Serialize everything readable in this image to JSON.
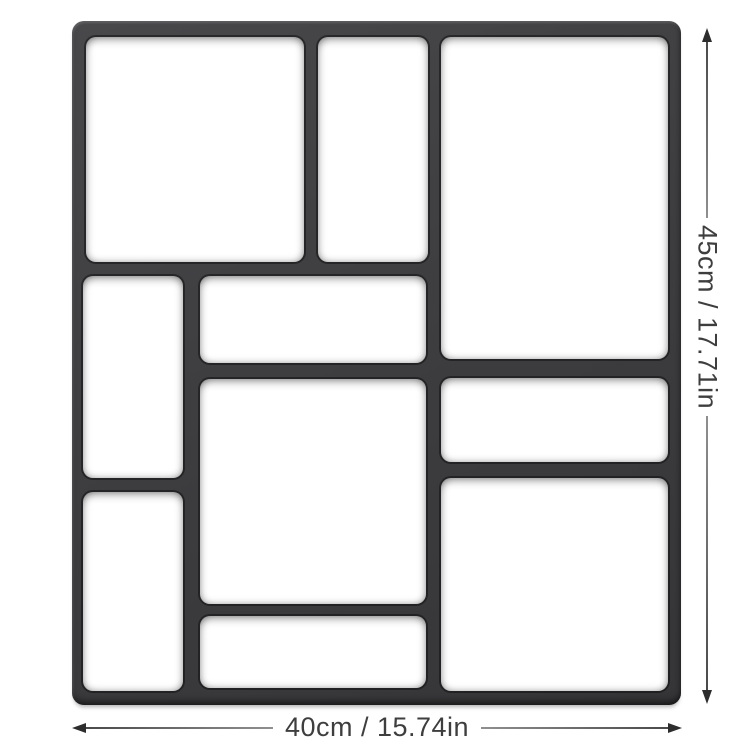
{
  "product": {
    "name": "paving-mold-top-view",
    "cavity_count": 10,
    "cavities": [
      {
        "id": "top-left",
        "x": 14,
        "y": 16,
        "w": 218,
        "h": 225
      },
      {
        "id": "top-center",
        "x": 246,
        "y": 16,
        "w": 110,
        "h": 225
      },
      {
        "id": "top-right",
        "x": 369,
        "y": 16,
        "w": 227,
        "h": 322
      },
      {
        "id": "middle-left",
        "x": 11,
        "y": 255,
        "w": 100,
        "h": 202
      },
      {
        "id": "middle-center",
        "x": 128,
        "y": 255,
        "w": 226,
        "h": 87
      },
      {
        "id": "center",
        "x": 128,
        "y": 358,
        "w": 226,
        "h": 225
      },
      {
        "id": "middle-right",
        "x": 369,
        "y": 357,
        "w": 227,
        "h": 84
      },
      {
        "id": "bottom-left",
        "x": 11,
        "y": 471,
        "w": 100,
        "h": 199
      },
      {
        "id": "bottom-center",
        "x": 128,
        "y": 595,
        "w": 226,
        "h": 72
      },
      {
        "id": "bottom-right",
        "x": 369,
        "y": 457,
        "w": 227,
        "h": 213
      }
    ]
  },
  "dimensions": {
    "height": {
      "label": "45cm / 17.71in",
      "side": "right",
      "orientation": "vertical"
    },
    "width": {
      "label": "40cm / 15.74in",
      "side": "bottom",
      "orientation": "horizontal"
    }
  },
  "colors": {
    "background": "#ffffff",
    "mold_body": "#3e3e40",
    "mold_highlight": "#48484b",
    "mold_shadow": "#232325",
    "cavity_fill": "#ffffff",
    "dimension_line": "#8f8f8f",
    "dimension_arrow": "#2d2d2d",
    "dimension_text": "#3e3e3e"
  }
}
